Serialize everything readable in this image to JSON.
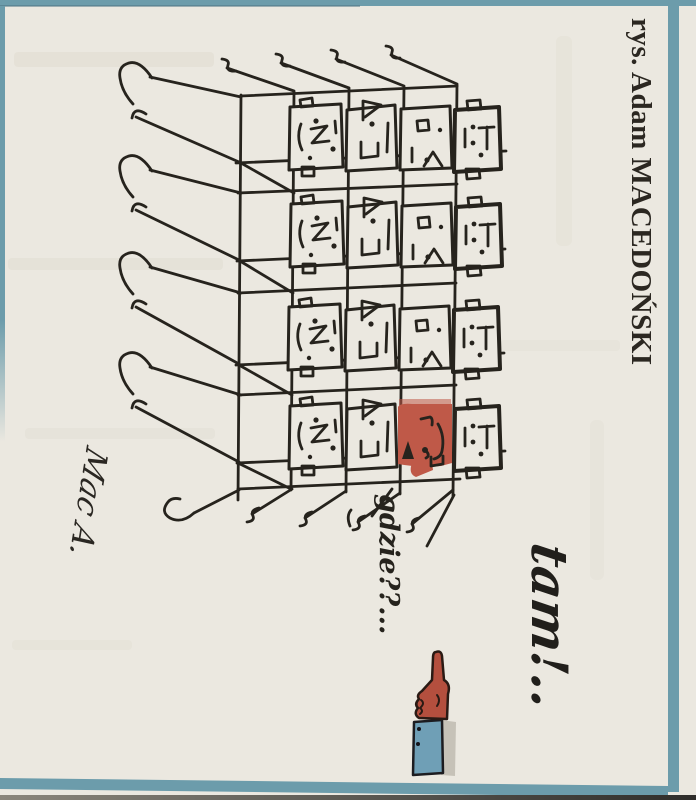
{
  "artist_credit": "rys. Adam MACEDOŃSKI",
  "speech": {
    "question": "gdzie??...",
    "answer": "tam!.."
  },
  "signature": "Mac A.",
  "colors": {
    "paper": "#ebe8e0",
    "frame_teal": "#6c9cab",
    "ink": "#26231d",
    "highlight_red": "#bf5948",
    "sleeve_blue": "#6f9fb6",
    "hand_red": "#b44f3e"
  }
}
